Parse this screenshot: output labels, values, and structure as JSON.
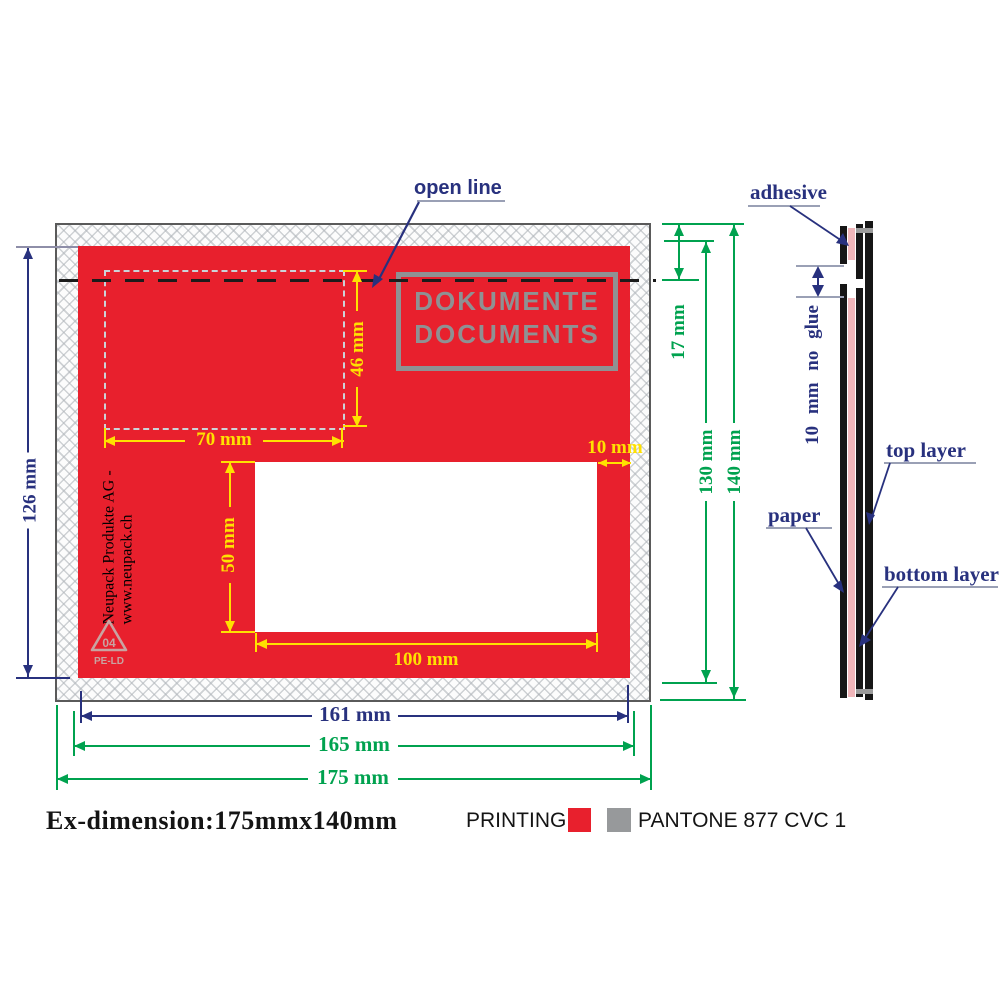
{
  "colors": {
    "envelope_red": "#e8202d",
    "pantone_gray": "#97999b",
    "dim_yellow": "#ffe100",
    "dim_green": "#00a24f",
    "dim_navy": "#28317e",
    "print_gray": "#8f9193",
    "adhesive_pink": "#f0b6ba"
  },
  "envelope": {
    "print_line1": "DOKUMENTE",
    "print_line2": "DOCUMENTS",
    "company_text": "Neupack  Produkte AG - www.neupack.ch",
    "recycle_code": "04",
    "recycle_material": "PE-LD"
  },
  "annotations": {
    "open_line": "open line",
    "dim_126": "126 mm",
    "dim_70": "70 mm",
    "dim_46": "46 mm",
    "dim_50": "50 mm",
    "dim_100": "100 mm",
    "dim_10": "10 mm",
    "dim_17": "17 mm",
    "dim_130": "130 mm",
    "dim_140": "140 mm",
    "dim_161": "161 mm",
    "dim_165": "165 mm",
    "dim_175": "175 mm"
  },
  "side_view": {
    "adhesive": "adhesive",
    "no_glue": "10 mm no glue",
    "top_layer": "top layer",
    "paper": "paper",
    "bottom_layer": "bottom layer"
  },
  "footer": {
    "ex_dimension": "Ex-dimension:175mmx140mm",
    "printing_label": "PRINTING:",
    "pantone_label": "PANTONE 877 CVC 1"
  }
}
